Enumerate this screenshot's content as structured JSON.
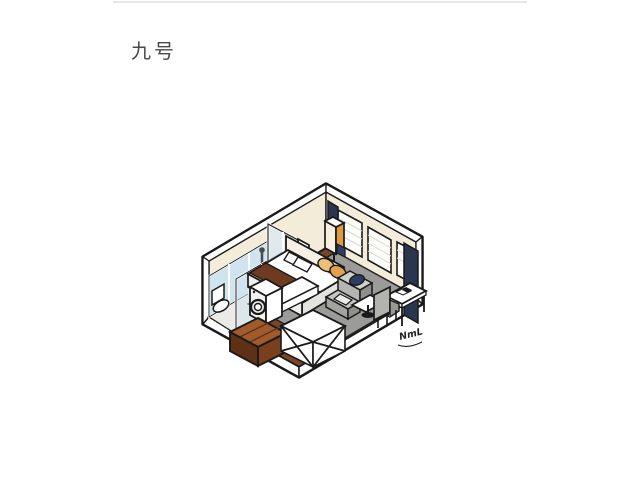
{
  "page": {
    "background_color": "#ffffff",
    "top_divider_color": "#e6e6e6"
  },
  "header": {
    "title": "九号",
    "title_color": "#4a4a4a"
  },
  "illustration": {
    "name": "isometric-hotel-room-cutaway",
    "signature": "NmL",
    "palette": {
      "outline": "#1a1a1a",
      "white": "#ffffff",
      "wall_cream": "#f3ecd8",
      "glass_blue": "#cfe3f0",
      "glass_blue_light": "#dbeaf4",
      "floor_wood": "#7b4527",
      "floor_wood_dark": "#5e3116",
      "bench_wood": "#a05a2c",
      "bathroom_floor": "#eceae4",
      "rug_gray": "#9b9b99",
      "sofa_gray": "#b5b5b1",
      "sofa_gray_dark": "#8f8f8b",
      "curtain_navy": "#2a3550",
      "cushion_navy": "#2e3d63",
      "blanket_brown": "#6e3b20",
      "pillow_tan": "#ecbf7a",
      "pillow_tan_dark": "#e2a050",
      "lamp_orange": "#dd9a44",
      "headboard_cream": "#f6f1e4"
    },
    "elements": [
      "bathroom-glass-enclosure",
      "toilet",
      "shower",
      "washing-machine",
      "wood-slat-bench",
      "luggage-rack",
      "tv-board",
      "double-bed",
      "pillows",
      "blanket",
      "floor-lamp",
      "sofa",
      "side-table",
      "desk",
      "desk-chair",
      "windows",
      "curtains",
      "rug",
      "wood-floor"
    ]
  }
}
